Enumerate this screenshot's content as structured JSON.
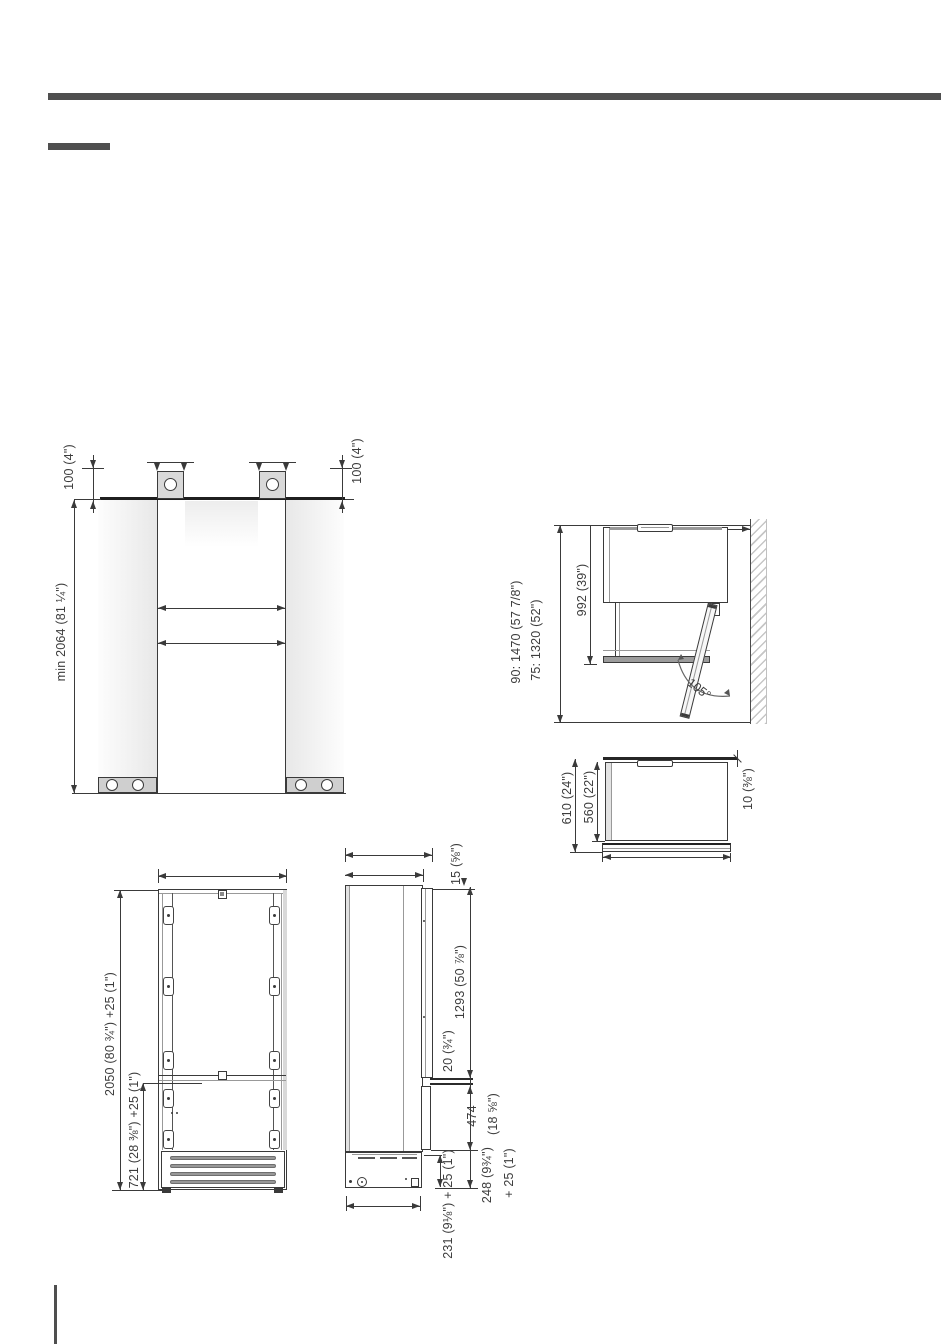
{
  "page": {
    "background": "#ffffff",
    "rule_color": "#4f4f4f",
    "line_color": "#3a3a3a"
  },
  "diagrams": {
    "niche": {
      "offset_left": "100 (4\")",
      "offset_right": "100 (4\")",
      "min_height": "min 2064 (81 ¼\")"
    },
    "door_open": {
      "depth_90": "90: 1470 (57 7/8\")",
      "depth_75": "75: 1320 (52\")",
      "depth_body": "992 (39\")",
      "angle": "105°"
    },
    "door_closed": {
      "depth_total": "610 (24\")",
      "depth_body": "560 (22\")",
      "wall_gap": "10 (⅜\")"
    },
    "front_view": {
      "total_height": "2050 (80 ¾\") +25 (1\")",
      "lower_height": "721 (28 ⅜\") +25 (1\")"
    },
    "side_view": {
      "top_gap": "15 (⅝\")",
      "upper_door": "1293 (50 ⅞\")",
      "door_gap": "20 (¾\")",
      "lower_door_mm": "474",
      "lower_door_in": "(18 ⅝\")",
      "base_mm": "248 (9¾\")",
      "base_plus": "+ 25 (1\")",
      "base_depth": "231 (9⅛\") + 25 (1\")"
    }
  }
}
